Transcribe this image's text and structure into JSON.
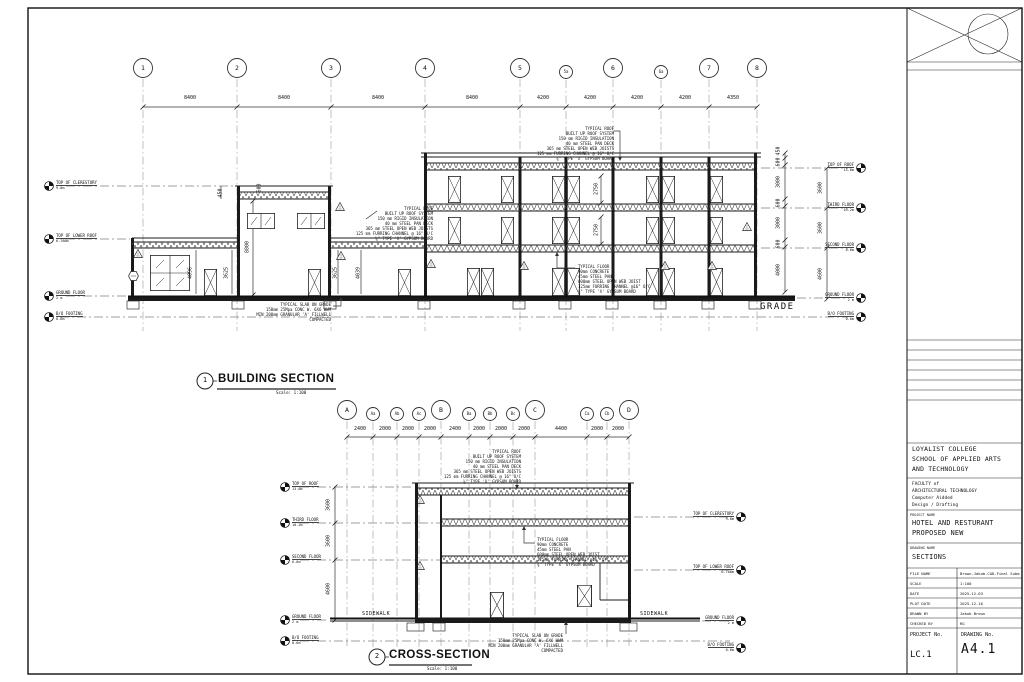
{
  "drawing": {
    "building_section": {
      "num": "1",
      "title": "BUILDING SECTION",
      "scale": "Scale: 1:100",
      "grade_label": "GRADE",
      "grid_bubbles": [
        "1",
        "2",
        "3",
        "4",
        "5",
        "5a",
        "6",
        "6a",
        "7",
        "8"
      ],
      "grid_dims": [
        "8400",
        "8400",
        "8400",
        "8400",
        "4200",
        "4200",
        "4200",
        "4200",
        "4350"
      ],
      "interior_dims": [
        "450",
        "600",
        "8800",
        "4096",
        "3625",
        "3625",
        "4039",
        "2750",
        "2750"
      ],
      "right_inner_dims": [
        "450",
        "600",
        "3000",
        "600",
        "3000",
        "600",
        "4000"
      ],
      "right_outer_dims": [
        "3600",
        "3600",
        "4600"
      ],
      "left_levels": [
        {
          "name": "TOP OF CLERESTORY",
          "elev": "9.8m"
        },
        {
          "name": "TOP OF LOWER ROOF",
          "elev": "6.780m"
        },
        {
          "name": "GROUND FLOOR",
          "elev": "2 m"
        },
        {
          "name": "B/O FOOTING",
          "elev": "0.6m"
        }
      ],
      "right_levels": [
        {
          "name": "TOP OF ROOF",
          "elev": "13.8m"
        },
        {
          "name": "THIRD FLOOR",
          "elev": "10.2m"
        },
        {
          "name": "SECOND FLOOR",
          "elev": "6.6m"
        },
        {
          "name": "GROUND FLOOR",
          "elev": "2 m"
        },
        {
          "name": "B/O FOOTING",
          "elev": "0.6m"
        }
      ]
    },
    "cross_section": {
      "num": "2",
      "title": "CROSS-SECTION",
      "scale": "Scale: 1:100",
      "sidewalk_left": "SIDEWALK",
      "sidewalk_right": "SIDEWALK",
      "grid_bubbles": [
        "A",
        "Aa",
        "Ab",
        "Ac",
        "B",
        "Ba",
        "Bb",
        "Bc",
        "C",
        "Ca",
        "Cb",
        "D"
      ],
      "grid_dims": [
        "2400",
        "2000",
        "2000",
        "2000",
        "2400",
        "2000",
        "2000",
        "2000",
        "4400",
        "2000",
        "2000"
      ],
      "left_dims": [
        "3600",
        "3600",
        "4600"
      ],
      "left_levels": [
        {
          "name": "TOP OF ROOF",
          "elev": "13.8m"
        },
        {
          "name": "THIRD FLOOR",
          "elev": "10.2m"
        },
        {
          "name": "SECOND FLOOR",
          "elev": "6.6m"
        },
        {
          "name": "GROUND FLOOR",
          "elev": "2 m"
        },
        {
          "name": "B/O FOOTING",
          "elev": "0.6m"
        }
      ],
      "right_levels": [
        {
          "name": "TOP OF CLERESTORY",
          "elev": "9.8m"
        },
        {
          "name": "TOP OF LOWER ROOF",
          "elev": "6.780m"
        },
        {
          "name": "GROUND FLOOR",
          "elev": "2 m"
        },
        {
          "name": "B/O FOOTING",
          "elev": "0.6m"
        }
      ]
    },
    "notes": {
      "typical_roof": [
        "TYPICAL ROOF",
        "BUILT UP ROOF SYSTEM",
        "150 mm RIGID INSULATION",
        "40 mm STEEL PAN DECK",
        "365 mm STEEL OPEN WEB JOISTS",
        "125 mm FURRING CHANNEL @ 16\" O/C",
        "⅝\" TYPE 'X' GYPSUM BOARD"
      ],
      "typical_floor": [
        "TYPICAL FLOOR",
        "90mm CONCRETE",
        "45mm STEEL PAN",
        "600mm STEEL OPEN WEB JOIST",
        "125mm FURRING CHANNEL @16\" O/C",
        "⅝\" TYPE 'X' GYPSUM BOARD"
      ],
      "typical_slab": [
        "TYPICAL SLAB ON GRADE",
        "150mm 25Mpa CONC W. 6X6 WWM",
        "MIN 200mm GRANULAR 'A' FILLWELL",
        "COMPACTED"
      ]
    }
  },
  "title_block": {
    "org": [
      "LOYALIST COLLEGE",
      "SCHOOL OF APPLIED ARTS",
      "AND TECHNOLOGY"
    ],
    "faculty": [
      "FACULTY of",
      "ARCHITECTURAL TECHNOLOGY",
      "Computer Aidded",
      "Design / Drafting"
    ],
    "project_label": "PROJECT NAME",
    "project": [
      "HOTEL AND RESTURANT",
      "PROPOSED NEW"
    ],
    "drawing_label": "DRAWING NAME",
    "drawing_name": "SECTIONS",
    "rows": [
      {
        "label": "FILE NAME",
        "value": "Brown-Jakob-CAD-Final Subm"
      },
      {
        "label": "SCALE",
        "value": "1:100"
      },
      {
        "label": "DATE",
        "value": "2025-12-03"
      },
      {
        "label": "PLOT DATE",
        "value": "2025-12-16"
      },
      {
        "label": "DRAWN BY",
        "value": "Jakob Brown"
      },
      {
        "label": "CHECKED BY",
        "value": "RG"
      }
    ],
    "project_no_label": "PROJECT No.",
    "project_no": "LC.1",
    "drawing_no_label": "DRAWING No.",
    "drawing_no": "A4.1"
  }
}
